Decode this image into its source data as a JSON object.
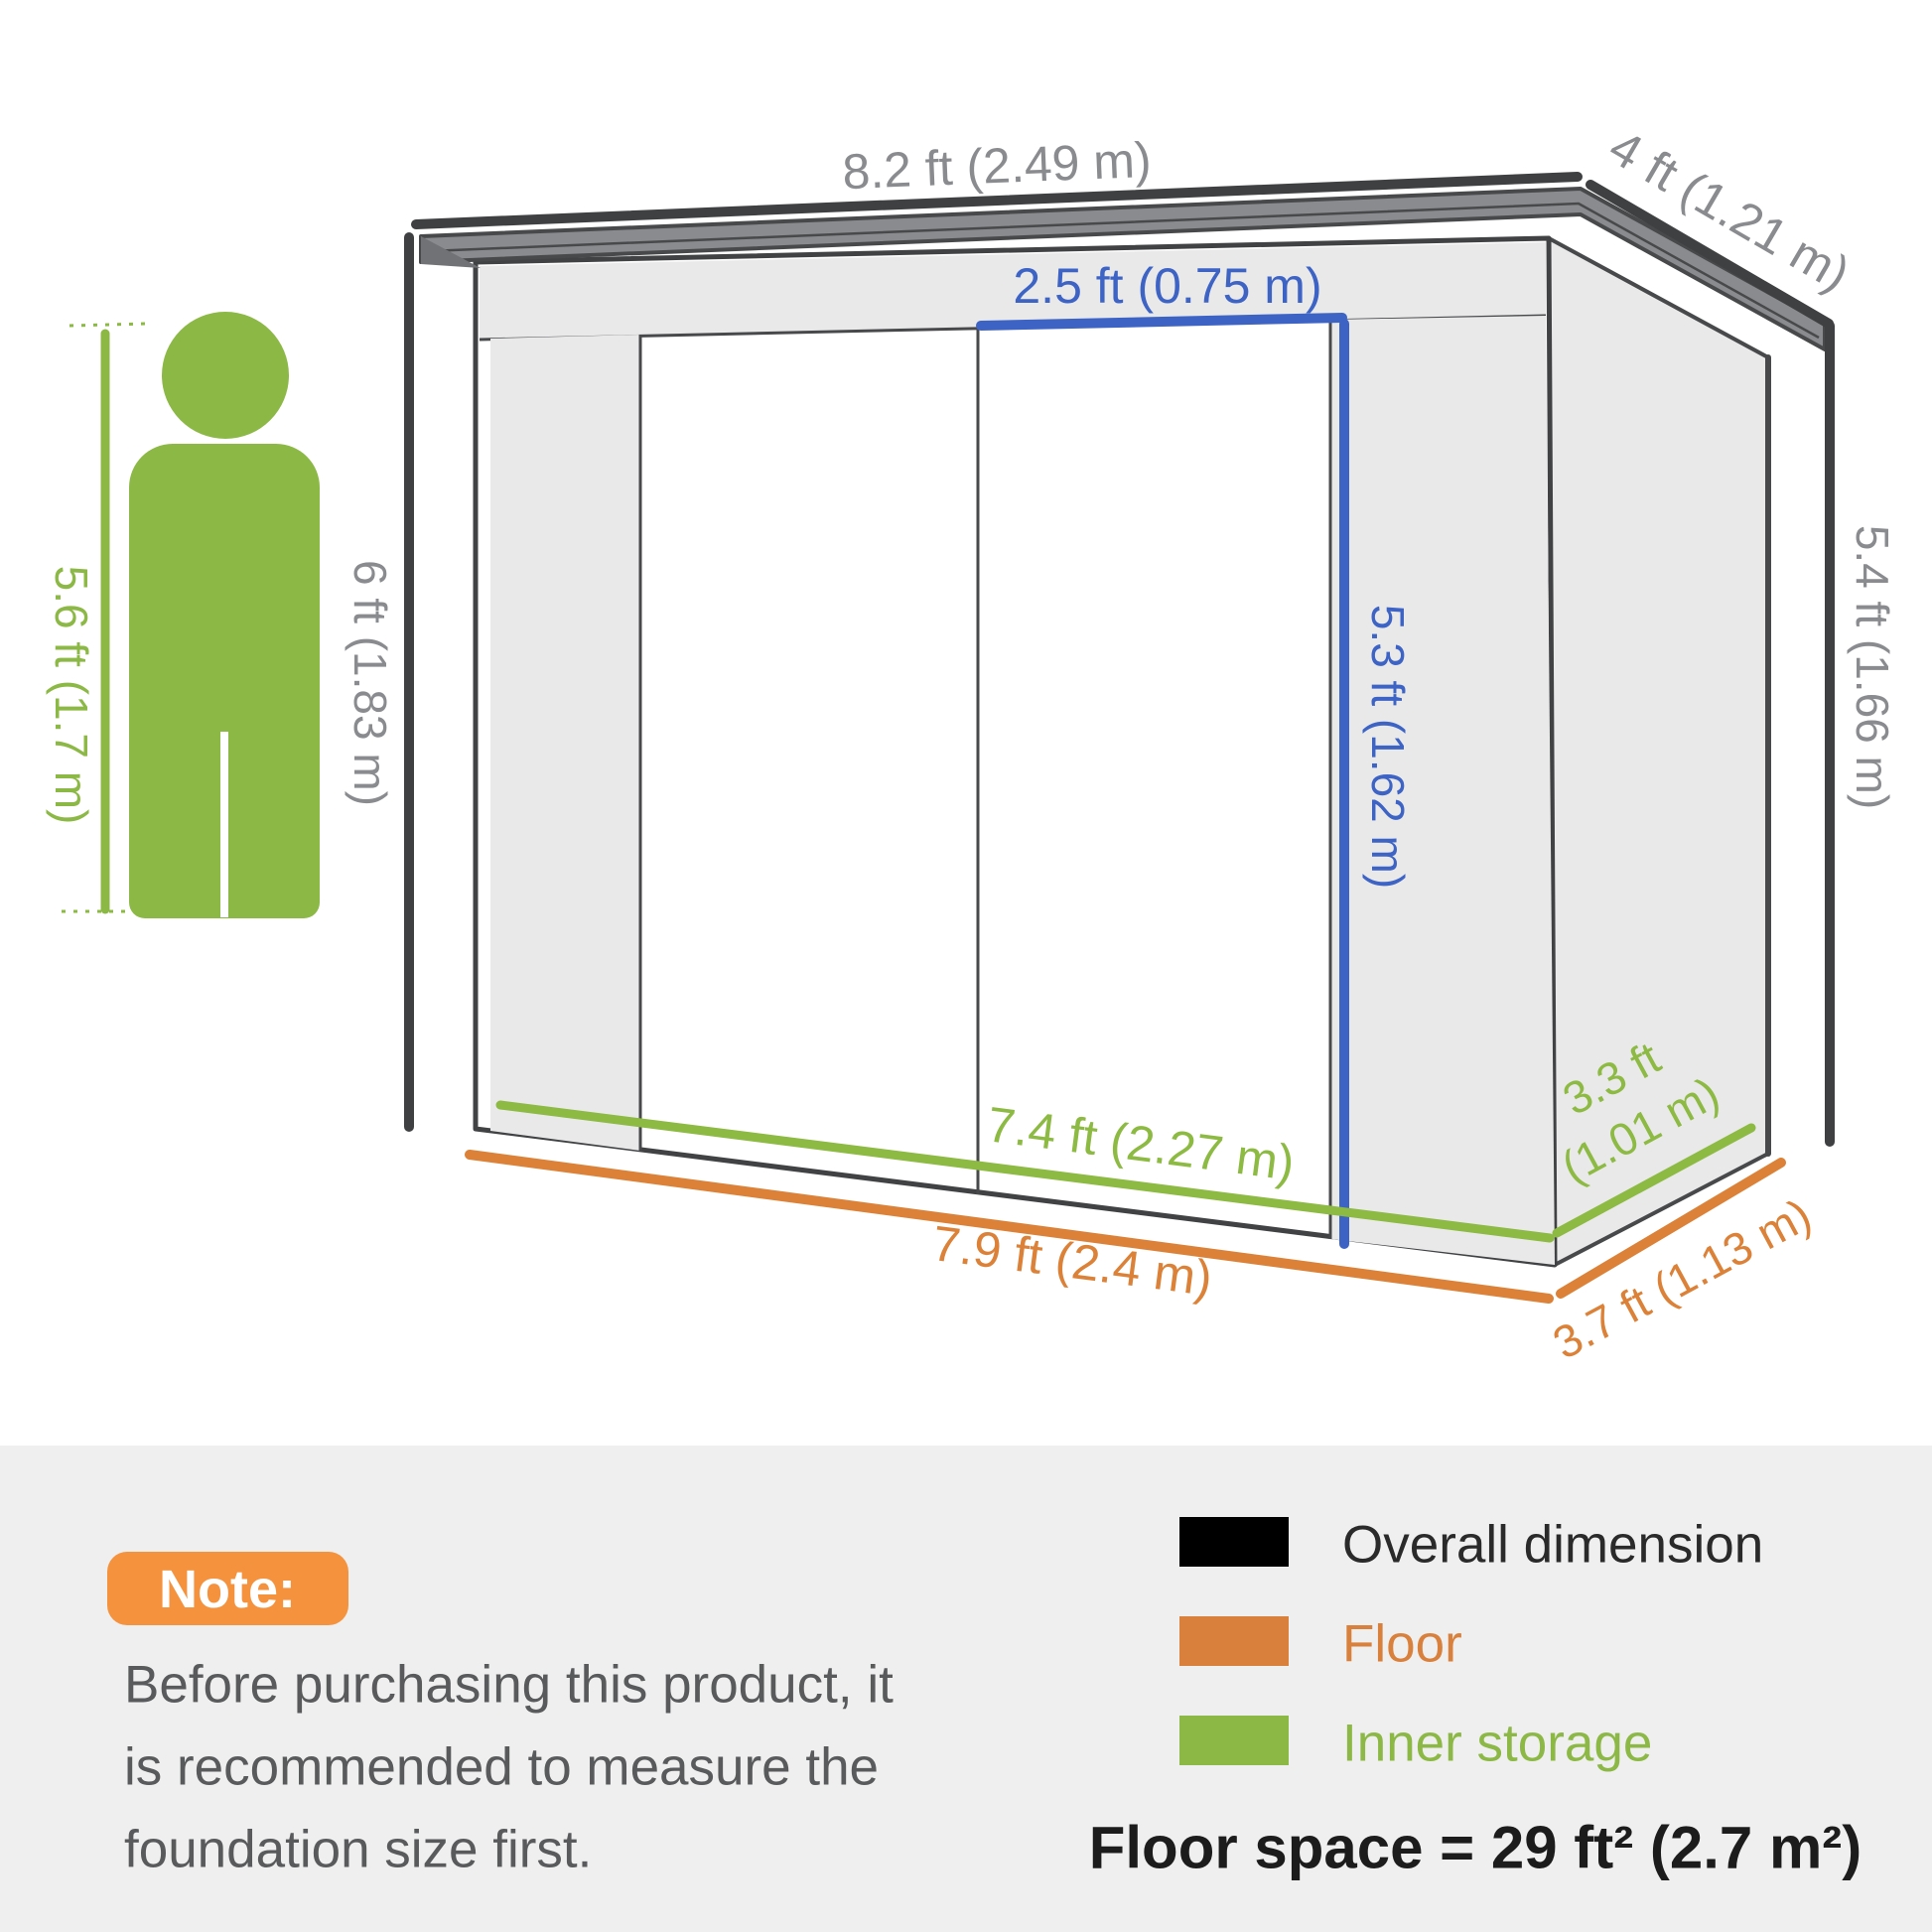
{
  "colors": {
    "overall": "#3f4042",
    "overall_text": "#8a8b8e",
    "floor_orange": "#dc8138",
    "legend_orange": "#d9813c",
    "inner_green": "#8cba42",
    "figure_green": "#8cb845",
    "door_blue": "#3d63c5",
    "roof_fill": "#8a8b8e",
    "roof_edge": "#48494b",
    "wall_fill": "#e9e9ea",
    "outline": "#414244",
    "band_bg": "#efefef",
    "note_badge_bg": "#f5923e",
    "note_badge_text": "#ffffff",
    "note_text": "#595a5c",
    "legend_black": "#000000",
    "legend_black_text": "#2a2a2a",
    "floorspace_text": "#1c1c1c"
  },
  "diagram": {
    "labels": {
      "roof_width": "8.2 ft (2.49 m)",
      "roof_depth": "4 ft (1.21 m)",
      "door_width": "2.5 ft (0.75 m)",
      "door_height": "5.3 ft (1.62 m)",
      "front_height": "6 ft (1.83 m)",
      "rear_height": "5.4 ft (1.66 m)",
      "inner_width": "7.4 ft (2.27 m)",
      "inner_depth_line1": "3.3 ft",
      "inner_depth_line2": "(1.01 m)",
      "floor_width": "7.9 ft (2.4 m)",
      "floor_depth": "3.7 ft (1.13 m)",
      "person_height": "5.6 ft (1.7 m)"
    }
  },
  "note": {
    "badge": "Note:",
    "lines": [
      "Before purchasing this product, it",
      "is recommended to measure the",
      "foundation size first."
    ]
  },
  "legend": {
    "items": [
      {
        "label": "Overall dimension"
      },
      {
        "label": "Floor"
      },
      {
        "label": "Inner storage"
      }
    ],
    "floor_space": "Floor space = 29 ft² (2.7 m²)"
  }
}
